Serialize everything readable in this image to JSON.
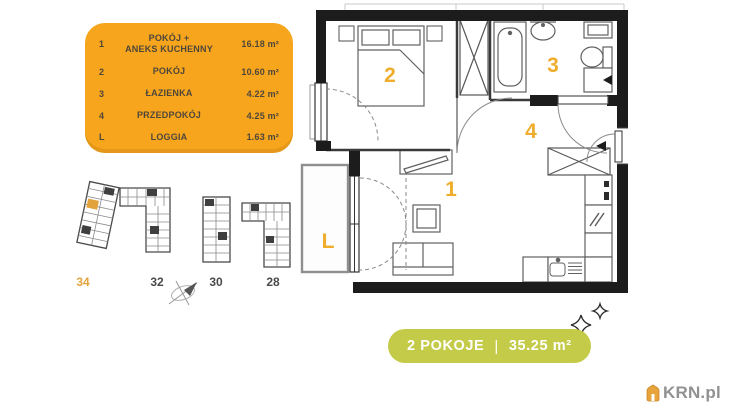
{
  "legend": {
    "bg_color": "#F6A51C",
    "text_color": "#4E463B",
    "rows": [
      {
        "num": "1",
        "name": "POKÓJ +\nANEKS KUCHENNY",
        "area": "16.18 m²"
      },
      {
        "num": "2",
        "name": "POKÓJ",
        "area": "10.60 m²"
      },
      {
        "num": "3",
        "name": "ŁAZIENKA",
        "area": "4.22 m²"
      },
      {
        "num": "4",
        "name": "PRZEDPOKÓJ",
        "area": "4.25 m²"
      },
      {
        "num": "L",
        "name": "LOGGIA",
        "area": "1.63 m²"
      }
    ]
  },
  "floorplan": {
    "label_color": "#EFAD2B",
    "room_labels": [
      {
        "text": "2"
      },
      {
        "text": "3"
      },
      {
        "text": "4"
      },
      {
        "text": "1"
      },
      {
        "text": "L"
      }
    ]
  },
  "siteplan": {
    "highlight_color": "#E2A33C",
    "label_color": "#4a4a4a",
    "buildings": [
      {
        "label": "34",
        "highlighted": true
      },
      {
        "label": "32",
        "highlighted": false
      },
      {
        "label": "30",
        "highlighted": false
      },
      {
        "label": "28",
        "highlighted": false
      }
    ]
  },
  "badge": {
    "bg_color": "#C4CB49",
    "rooms": "2 POKOJE",
    "divider": "|",
    "area": "35.25 m²"
  },
  "watermark": {
    "text": "KRN.pl"
  }
}
